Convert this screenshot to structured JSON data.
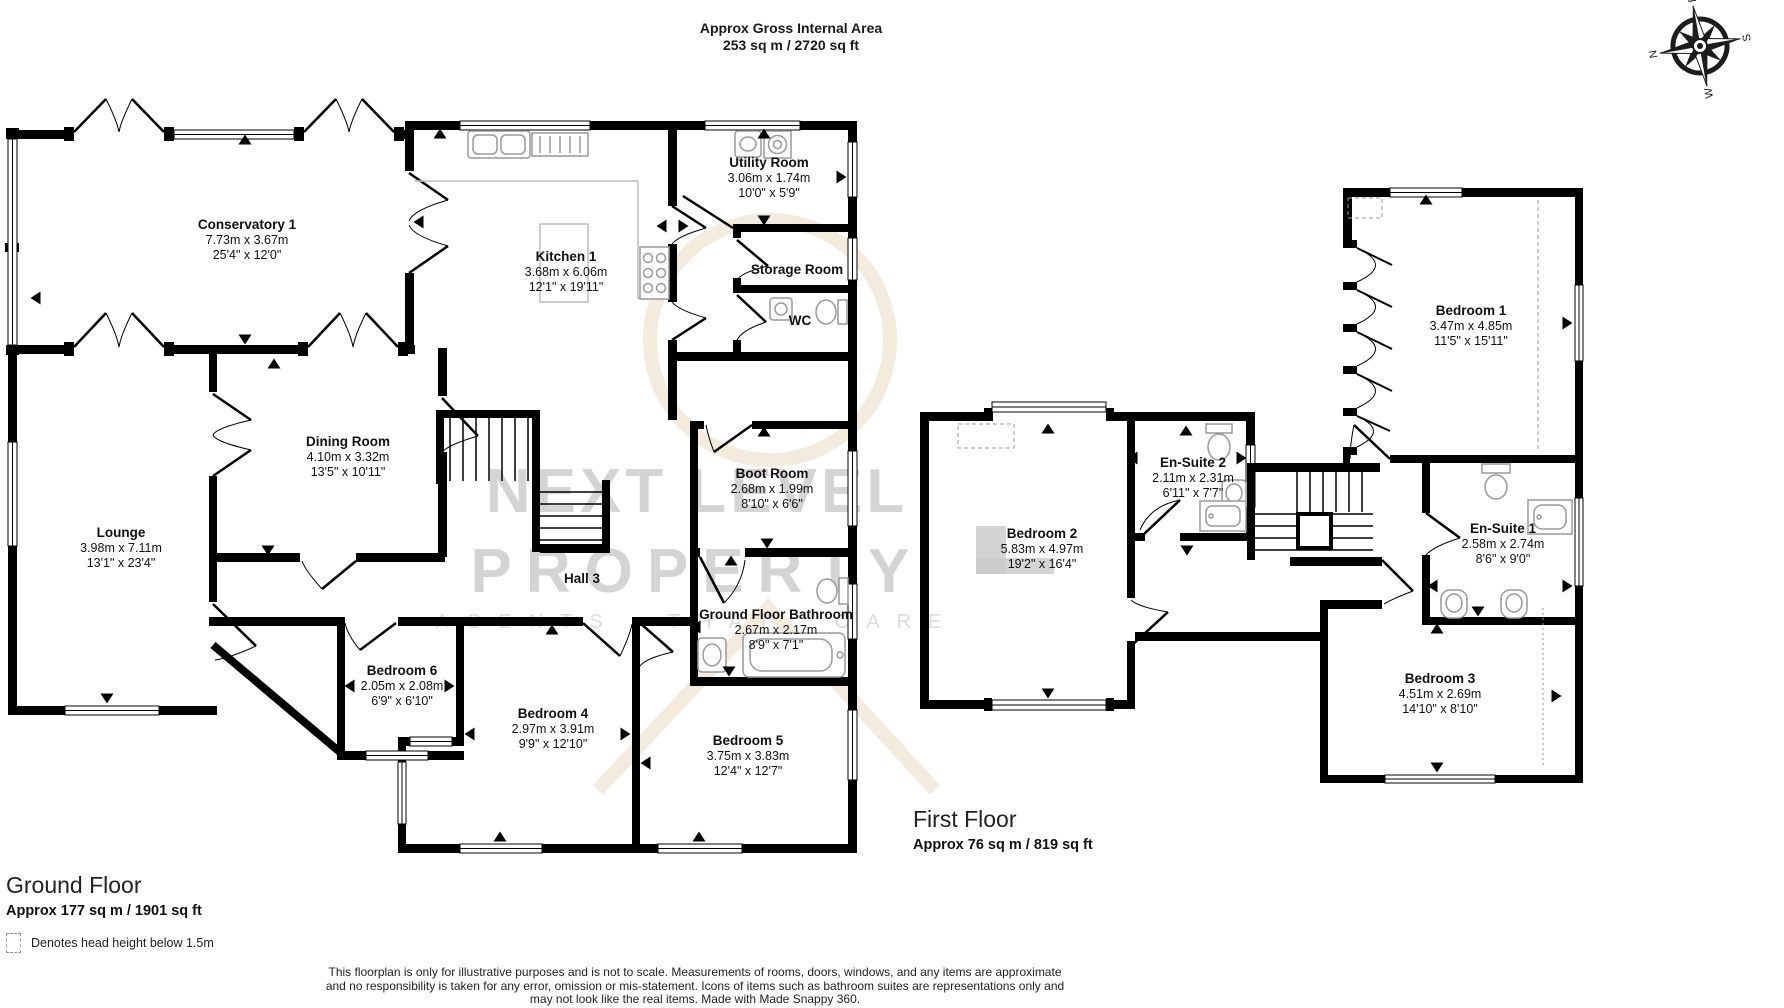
{
  "header": {
    "line1": "Approx Gross Internal Area",
    "line2": "253 sq m / 2720 sq ft"
  },
  "compass": {
    "n": "N",
    "e": "E",
    "s": "S",
    "w": "W"
  },
  "watermark": {
    "brand_line1": "NEXT LEVEL",
    "brand_line2": "PROPERTY",
    "tagline": "AGENTS THAT CARE"
  },
  "ground_floor": {
    "title": "Ground Floor",
    "area": "Approx 177 sq m / 1901 sq ft",
    "rooms": {
      "conservatory": {
        "name": "Conservatory 1",
        "metric": "7.73m x 3.67m",
        "imperial": "25'4\" x 12'0\""
      },
      "kitchen": {
        "name": "Kitchen 1",
        "metric": "3.68m x 6.06m",
        "imperial": "12'1\" x 19'11\""
      },
      "utility": {
        "name": "Utility Room",
        "metric": "3.06m x 1.74m",
        "imperial": "10'0\" x 5'9\""
      },
      "storage": {
        "name": "Storage Room"
      },
      "wc": {
        "name": "WC"
      },
      "dining": {
        "name": "Dining Room",
        "metric": "4.10m x 3.32m",
        "imperial": "13'5\" x 10'11\""
      },
      "lounge": {
        "name": "Lounge",
        "metric": "3.98m x 7.11m",
        "imperial": "13'1\" x 23'4\""
      },
      "hall": {
        "name": "Hall 3"
      },
      "boot": {
        "name": "Boot Room",
        "metric": "2.68m x 1.99m",
        "imperial": "8'10\" x 6'6\""
      },
      "bathroom": {
        "name": "Ground Floor Bathroom",
        "metric": "2.67m x 2.17m",
        "imperial": "8'9\" x 7'1\""
      },
      "bedroom6": {
        "name": "Bedroom 6",
        "metric": "2.05m x 2.08m",
        "imperial": "6'9\" x 6'10\""
      },
      "bedroom4": {
        "name": "Bedroom 4",
        "metric": "2.97m x 3.91m",
        "imperial": "9'9\" x 12'10\""
      },
      "bedroom5": {
        "name": "Bedroom 5",
        "metric": "3.75m x 3.83m",
        "imperial": "12'4\" x 12'7\""
      }
    }
  },
  "first_floor": {
    "title": "First Floor",
    "area": "Approx 76 sq m / 819 sq ft",
    "rooms": {
      "bedroom2": {
        "name": "Bedroom 2",
        "metric": "5.83m x 4.97m",
        "imperial": "19'2\" x 16'4\""
      },
      "ensuite2": {
        "name": "En-Suite 2",
        "metric": "2.11m x 2.31m",
        "imperial": "6'11\" x 7'7\""
      },
      "bedroom1": {
        "name": "Bedroom 1",
        "metric": "3.47m x 4.85m",
        "imperial": "11'5\" x 15'11\""
      },
      "ensuite1": {
        "name": "En-Suite 1",
        "metric": "2.58m x 2.74m",
        "imperial": "8'6\" x 9'0\""
      },
      "bedroom3": {
        "name": "Bedroom 3",
        "metric": "4.51m x 2.69m",
        "imperial": "14'10\" x 8'10\""
      }
    }
  },
  "legend": {
    "text": "Denotes head height below 1.5m"
  },
  "footer": {
    "line1": "This floorplan is only for illustrative purposes and is not to scale. Measurements of rooms, doors, windows, and any items are approximate",
    "line2": "and no responsibility is taken for any error, omission or mis-statement. Icons of items such as bathroom suites are representations only and",
    "line3": "may not look like the real items. Made with Made Snappy 360."
  },
  "colors": {
    "wall": "#000000",
    "watermark_text": "#d4d4d4",
    "watermark_swoosh": "#e4d2b4",
    "fixture": "#b3b3b3"
  }
}
